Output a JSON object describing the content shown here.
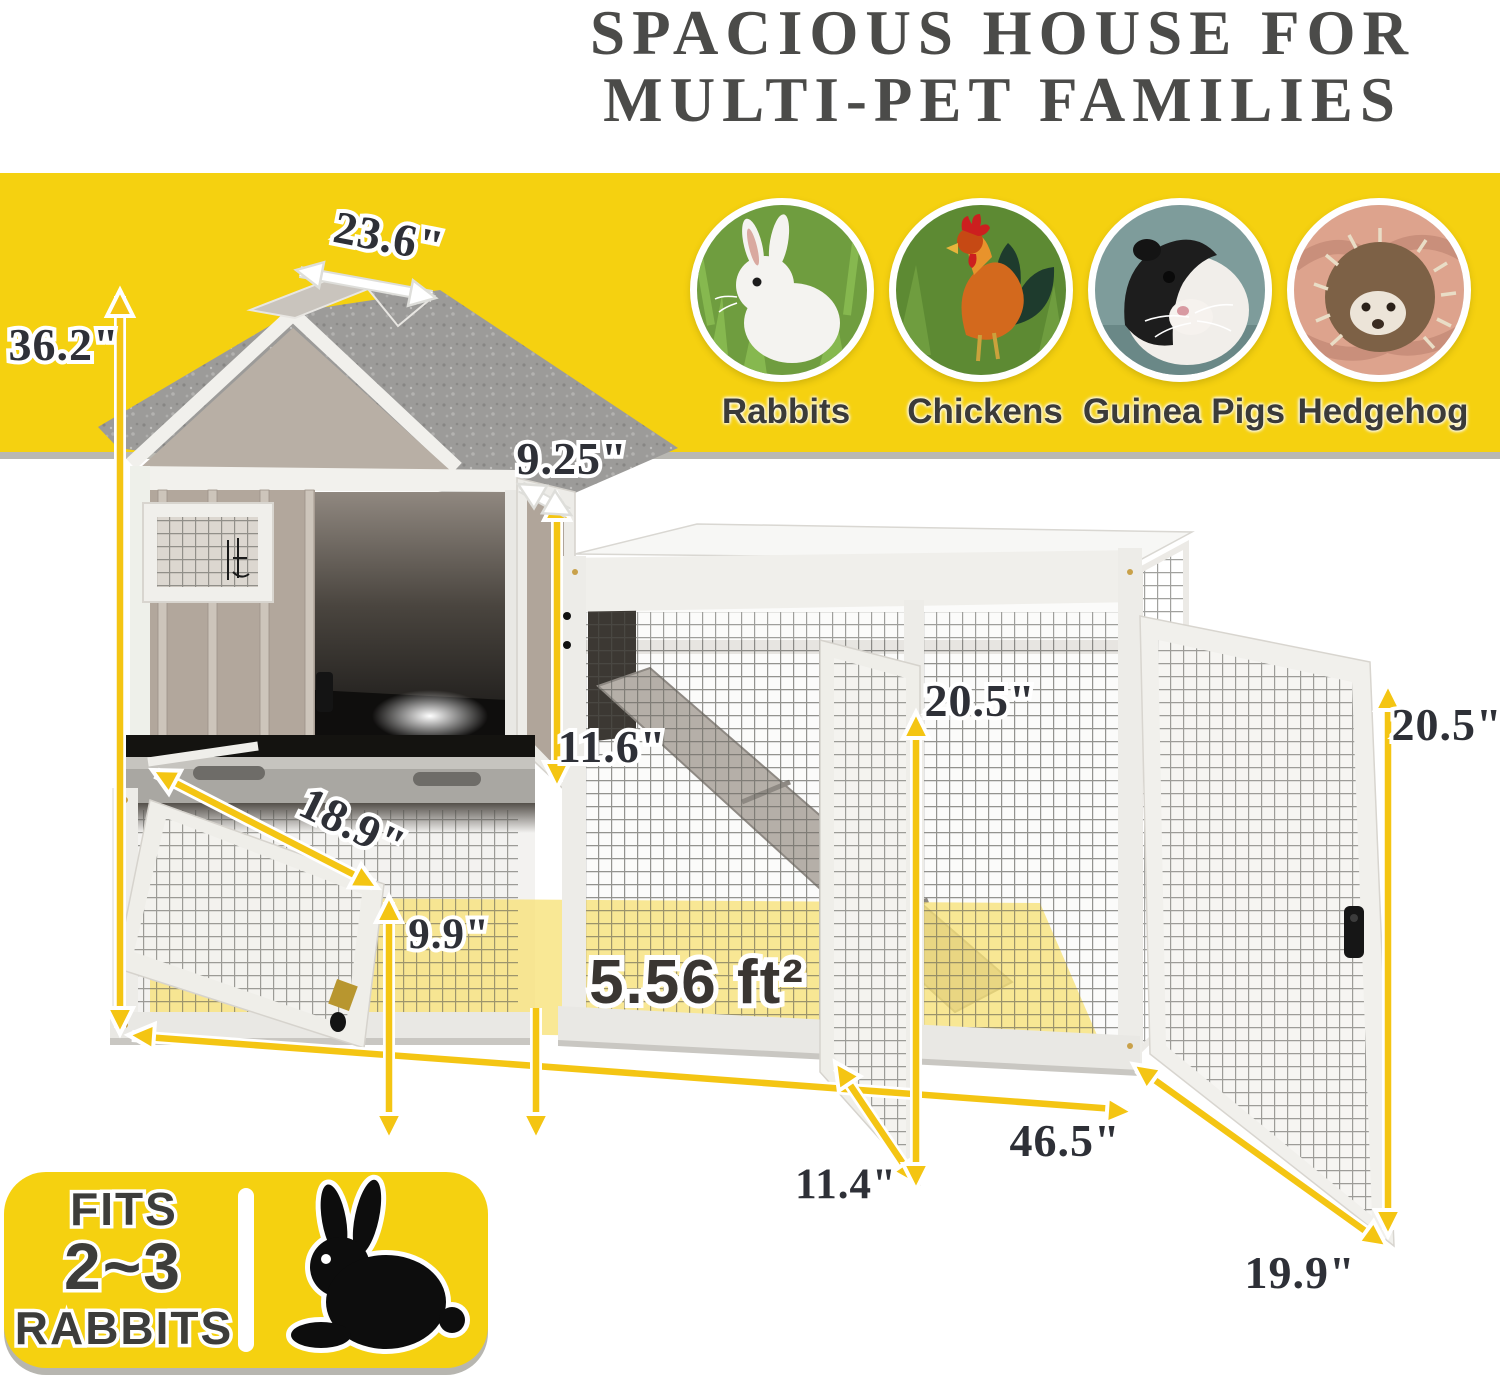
{
  "title": {
    "line1": "SPACIOUS HOUSE FOR",
    "line2": "MULTI-PET FAMILIES"
  },
  "pets": [
    {
      "label": "Rabbits"
    },
    {
      "label": "Chickens"
    },
    {
      "label": "Guinea Pigs"
    },
    {
      "label": "Hedgehog"
    }
  ],
  "dims": {
    "roof_depth": "23.6\"",
    "total_height": "36.2\"",
    "upper_door_depth": "9.25\"",
    "upper_door_height": "11.6\"",
    "hutch_depth": "18.9\"",
    "ground_clearance": "9.9\"",
    "run_height_mid": "20.5\"",
    "run_height_right": "20.5\"",
    "run_length": "46.5\"",
    "middle_door_width": "11.4\"",
    "right_door_width": "19.9\"",
    "floor_area": "5.56 ft²"
  },
  "badge": {
    "line1": "FITS",
    "line2": "2~3",
    "line3": "RABBITS"
  },
  "colors": {
    "banner_yellow": "#F5D110",
    "arrow_yellow": "#F4C513",
    "floor_highlight": "#F7E177",
    "title_color": "#4B4B49",
    "roof_gray": "#9C9B99",
    "wood_taupe": "#B2A79C"
  }
}
